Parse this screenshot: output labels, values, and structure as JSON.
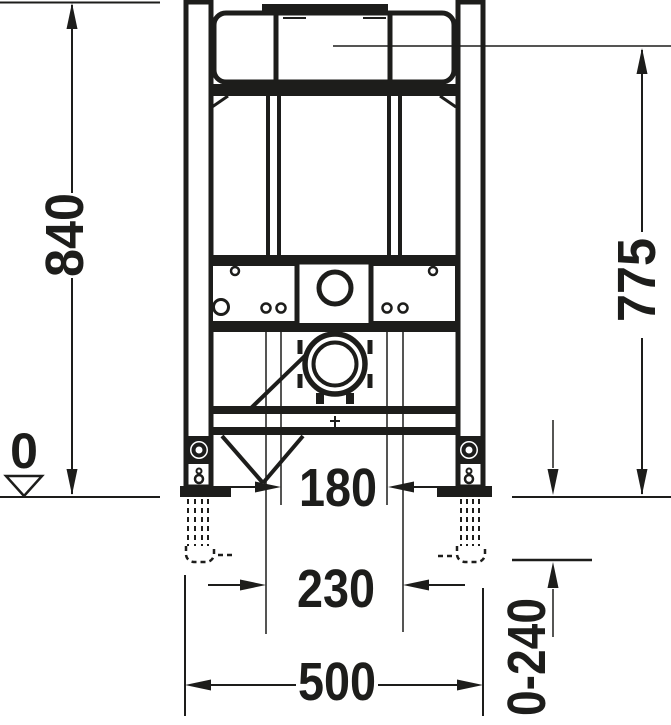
{
  "meta": {
    "ink_color": "#1d1d1b",
    "background_color": "#ffffff",
    "drawing_kind": "installation-frame-dimension-drawing"
  },
  "dimensions": {
    "total_height": "840",
    "connection_height": "775",
    "floor_level": "0",
    "inner_hole_spacing": "180",
    "outer_hole_spacing": "230",
    "frame_width": "500",
    "foot_adjustment_range": "0-240"
  }
}
